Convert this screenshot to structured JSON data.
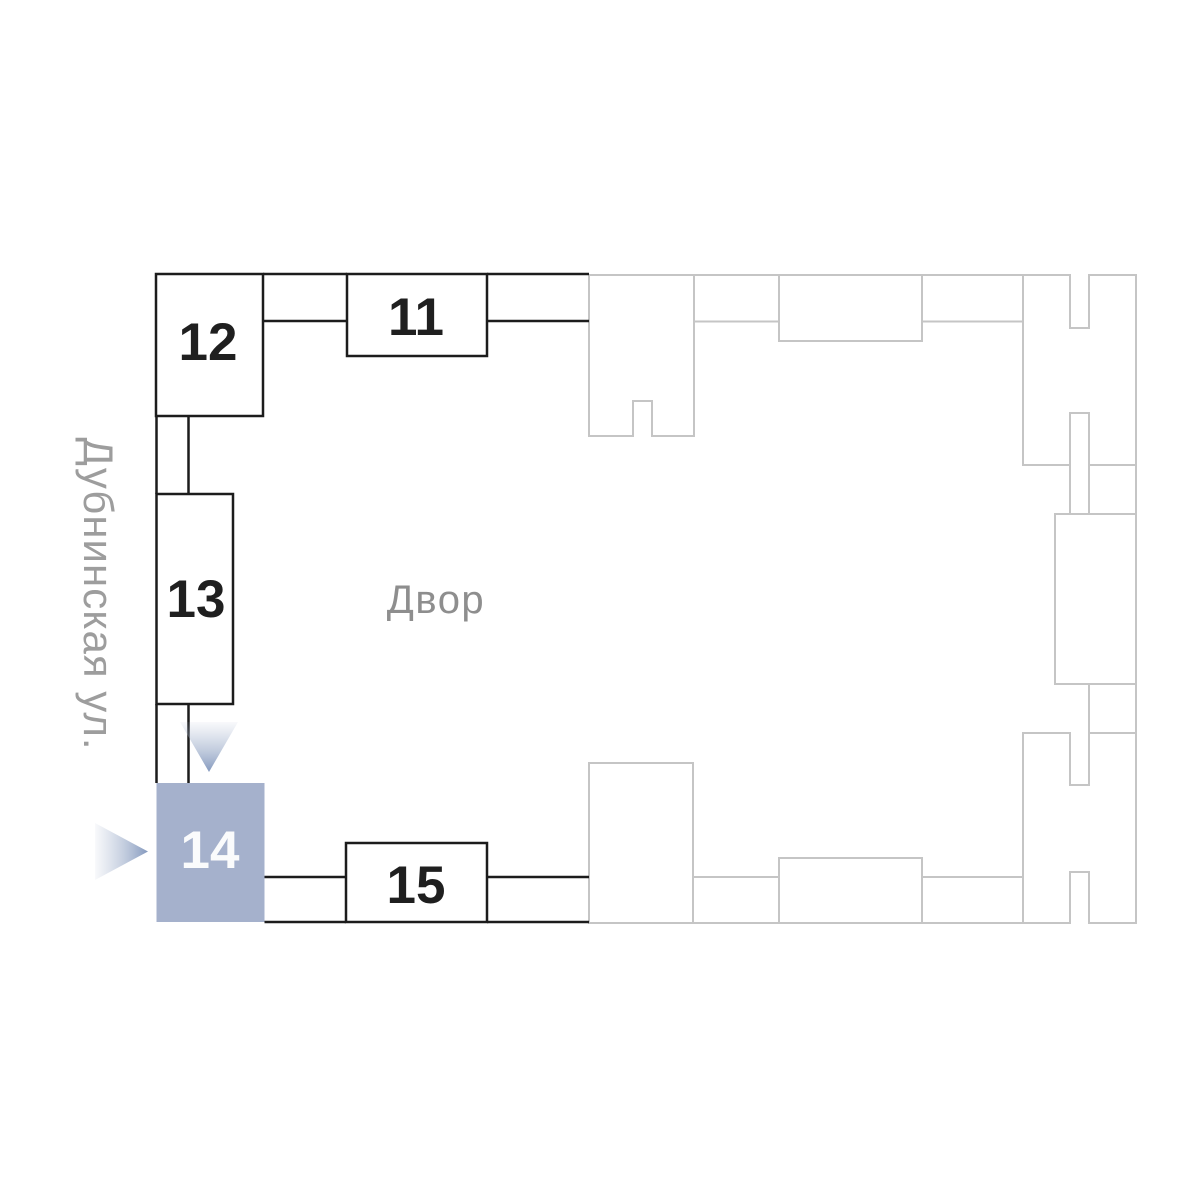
{
  "plan": {
    "street_label": "Дубнинская ул.",
    "courtyard_label": "Двор",
    "buildings": [
      {
        "number": "11",
        "state": "default"
      },
      {
        "number": "12",
        "state": "default"
      },
      {
        "number": "13",
        "state": "default"
      },
      {
        "number": "14",
        "state": "selected"
      },
      {
        "number": "15",
        "state": "default"
      }
    ],
    "colors": {
      "outline_dark": "#1c1c1c",
      "outline_muted": "#c5c5c5",
      "selected_fill": "#a5b1cc",
      "selected_number": "#fafbfc",
      "number": "#1f1f1f",
      "courtyard_text": "#8e8e8e",
      "street_text": "#9d9d9d",
      "arrow_tip": "#8499be"
    }
  }
}
